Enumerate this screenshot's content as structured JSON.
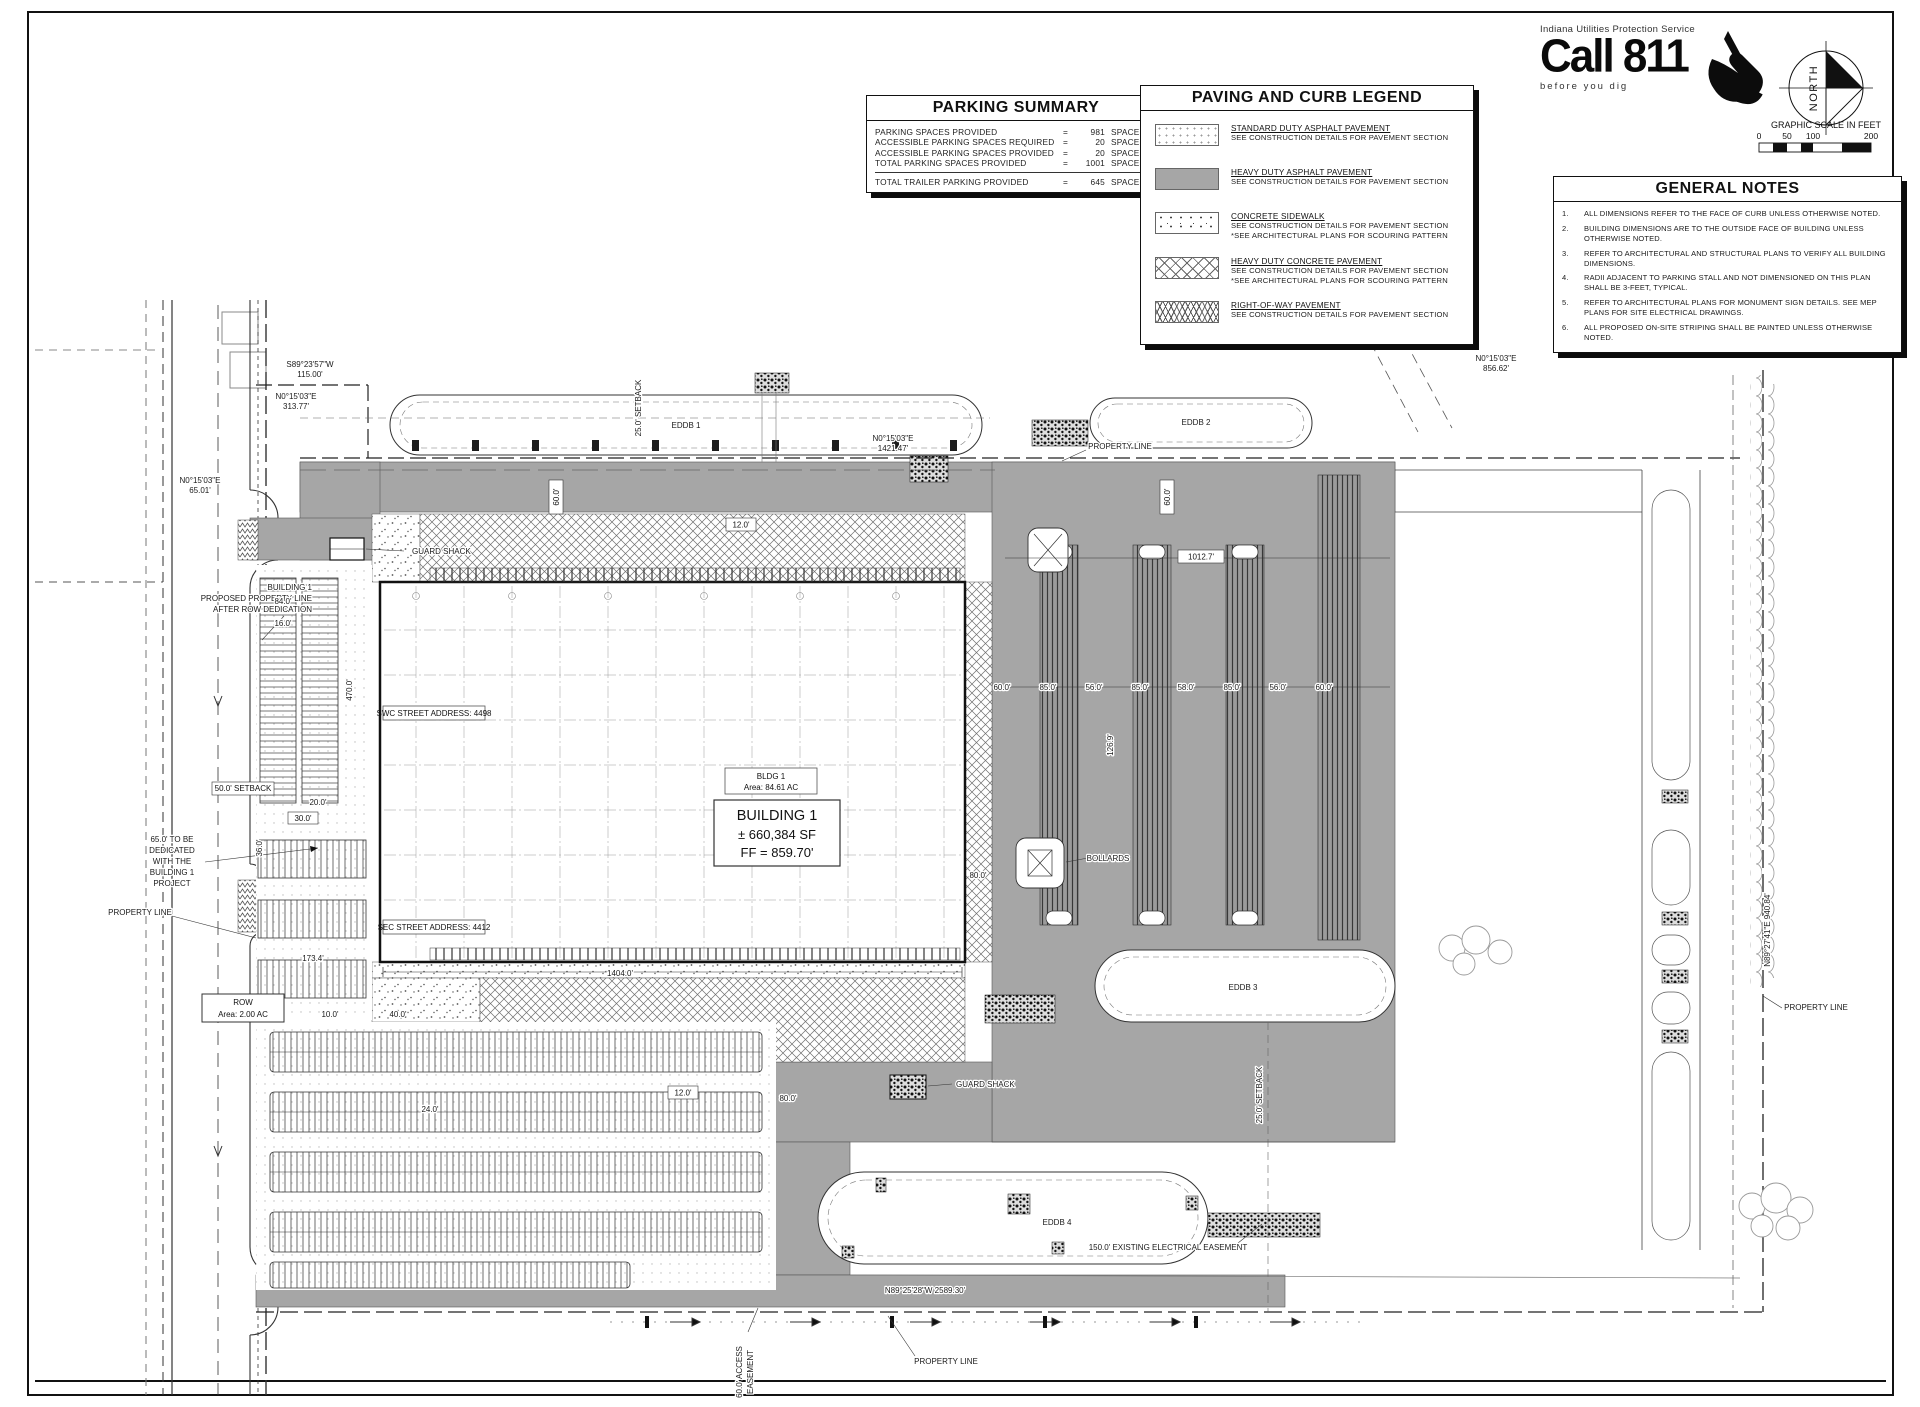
{
  "parking_summary": {
    "title": "PARKING SUMMARY",
    "rows": [
      {
        "label": "PARKING SPACES PROVIDED",
        "eq": "=",
        "value": "981",
        "unit": "SPACES"
      },
      {
        "label": "ACCESSIBLE PARKING SPACES REQUIRED",
        "eq": "=",
        "value": "20",
        "unit": "SPACES"
      },
      {
        "label": "ACCESSIBLE PARKING SPACES PROVIDED",
        "eq": "=",
        "value": "20",
        "unit": "SPACES"
      },
      {
        "label": "TOTAL PARKING SPACES PROVIDED",
        "eq": "=",
        "value": "1001",
        "unit": "SPACES"
      }
    ],
    "total": {
      "label": "TOTAL TRAILER PARKING PROVIDED",
      "eq": "=",
      "value": "645",
      "unit": "SPACES"
    }
  },
  "legend": {
    "title": "PAVING AND CURB LEGEND",
    "items": [
      {
        "name": "STANDARD DUTY ASPHALT PAVEMENT",
        "note1": "SEE CONSTRUCTION DETAILS FOR PAVEMENT SECTION"
      },
      {
        "name": "HEAVY DUTY ASPHALT PAVEMENT",
        "note1": "SEE CONSTRUCTION DETAILS FOR PAVEMENT SECTION"
      },
      {
        "name": "CONCRETE SIDEWALK",
        "note1": "SEE CONSTRUCTION DETAILS FOR PAVEMENT SECTION",
        "note2": "*SEE ARCHITECTURAL PLANS FOR SCOURING PATTERN"
      },
      {
        "name": "HEAVY DUTY CONCRETE PAVEMENT",
        "note1": "SEE CONSTRUCTION DETAILS FOR PAVEMENT SECTION",
        "note2": "*SEE ARCHITECTURAL PLANS FOR SCOURING PATTERN"
      },
      {
        "name": "RIGHT-OF-WAY PAVEMENT",
        "note1": "SEE CONSTRUCTION DETAILS FOR PAVEMENT SECTION"
      }
    ]
  },
  "call811": {
    "agency": "Indiana Utilities Protection Service",
    "logo": "Call 811",
    "tagline": "before  you  dig"
  },
  "north": {
    "label": "NORTH"
  },
  "scale": {
    "title": "GRAPHIC SCALE IN FEET",
    "t0": "0",
    "t50": "50",
    "t100": "100",
    "t200": "200"
  },
  "general_notes": {
    "title": "GENERAL NOTES",
    "notes": [
      {
        "num": "1.",
        "text": "ALL DIMENSIONS REFER TO THE FACE OF CURB UNLESS OTHERWISE NOTED."
      },
      {
        "num": "2.",
        "text": "BUILDING DIMENSIONS ARE TO THE OUTSIDE FACE OF BUILDING UNLESS OTHERWISE NOTED."
      },
      {
        "num": "3.",
        "text": "REFER TO ARCHITECTURAL AND STRUCTURAL PLANS TO VERIFY ALL BUILDING DIMENSIONS."
      },
      {
        "num": "4.",
        "text": "RADII ADJACENT TO PARKING STALL AND NOT DIMENSIONED ON THIS PLAN SHALL BE 3-FEET, TYPICAL."
      },
      {
        "num": "5.",
        "text": "REFER TO ARCHITECTURAL PLANS FOR MONUMENT SIGN DETAILS. SEE MEP PLANS FOR SITE ELECTRICAL DRAWINGS."
      },
      {
        "num": "6.",
        "text": "ALL PROPOSED ON-SITE STRIPING SHALL BE PAINTED UNLESS OTHERWISE NOTED."
      }
    ]
  },
  "plan": {
    "building": {
      "tag1": "BLDG 1",
      "tag2": "Area:  84.61  AC",
      "name": "BUILDING 1",
      "sf": "± 660,384 SF",
      "ff": "FF = 859.70'",
      "swc": "SWC STREET ADDRESS: 4498",
      "sec": "SEC STREET ADDRESS: 4412"
    },
    "labels": {
      "property_line": "PROPERTY LINE",
      "guard_shack": "GUARD SHACK",
      "bollards": "BOLLARDS",
      "eddb1": "EDDB 1",
      "eddb2": "EDDB 2",
      "eddb3": "EDDB 3",
      "eddb4": "EDDB 4",
      "row": "ROW",
      "row_area": "Area:  2.00  AC",
      "setback50": "50.0' SETBACK",
      "setback25": "25.0' SETBACK",
      "elec": "150.0' EXISTING ELECTRICAL EASEMENT",
      "access1": "60.0' ACCESS",
      "access2": "EASEMENT",
      "ded1": "65.0' TO BE",
      "ded2": "DEDICATED",
      "ded3": "WITH THE",
      "ded4": "BUILDING 1",
      "ded5": "PROJECT",
      "par1": "BUILDING 1",
      "par2": "PROPOSED PROPERTY LINE",
      "par3": "AFTER ROW DEDICATION"
    },
    "bearings": {
      "tl1a": "S89°23'57\"W",
      "tl1b": "115.00'",
      "tl2a": "N0°15'03\"E",
      "tl2b": "313.77'",
      "lsa": "N0°15'03\"E",
      "lsb": "65.01'",
      "tma": "N0°15'03\"E",
      "tmb": "1421.47'",
      "tra": "N0°15'03\"E",
      "trb": "856.62'",
      "bottom": "N89°25'28\"W  2589.30'",
      "right": "N89°27'41\"E  940.84'"
    },
    "dims": {
      "d1404": "1404.0'",
      "d470": "470.0'",
      "d1012": "1012.7'",
      "d173": "173.4'",
      "d12": "12.0'",
      "d60": "60.0'",
      "d85": "85.0'",
      "d56": "56.0'",
      "d58": "58.0'",
      "d80": "80.0'",
      "d84": "84.0'",
      "d24": "24.0'",
      "d40": "40.0'",
      "d10": "10.0'",
      "d20": "20.0'",
      "d30": "30.0'",
      "d16": "16.0'",
      "d36": "36.0'",
      "d126": "126.9'"
    }
  }
}
